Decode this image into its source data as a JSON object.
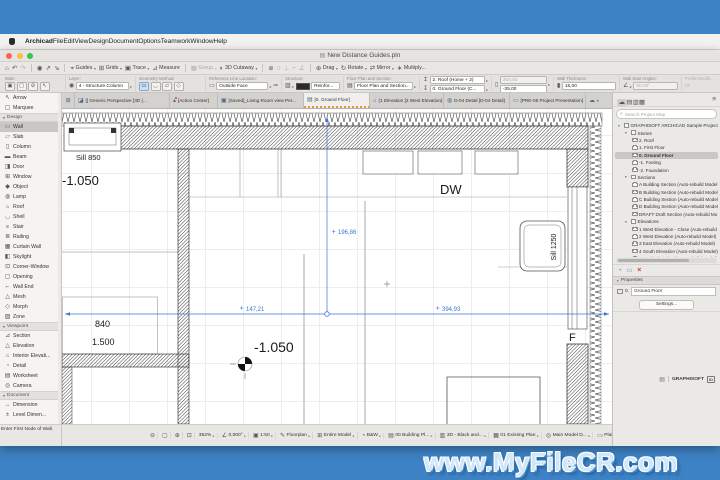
{
  "desktop": {
    "watermark": "www.MyFileCR.com"
  },
  "menu_bar": {
    "items": [
      {
        "label": "Archicad",
        "cls": "b",
        "name": "archicad"
      },
      {
        "label": "File",
        "name": "file"
      },
      {
        "label": "Edit",
        "name": "edit"
      },
      {
        "label": "View",
        "name": "view"
      },
      {
        "label": "Design",
        "name": "design"
      },
      {
        "label": "Document",
        "name": "document"
      },
      {
        "label": "Options",
        "name": "options"
      },
      {
        "label": "Teamwork",
        "name": "teamwork"
      },
      {
        "label": "Window",
        "name": "window"
      },
      {
        "label": "Help",
        "name": "help"
      }
    ]
  },
  "window": {
    "title": "New Distance Guides.pln"
  },
  "toolbar": {
    "items": [
      {
        "icon": "⌂",
        "name": "home"
      },
      {
        "icon": "↶",
        "name": "undo"
      },
      {
        "icon": "↷",
        "cls": "dis",
        "name": "redo"
      },
      {
        "cls": "sep",
        "name": "separator"
      },
      {
        "icon": "◉",
        "name": "favorites"
      },
      {
        "icon": "⇗",
        "name": "pick-up-parameters"
      },
      {
        "icon": "⇘",
        "name": "inject-parameters"
      },
      {
        "cls": "sep",
        "name": "separator"
      },
      {
        "icon": "⌖",
        "label": "Guides",
        "chev": "▾",
        "name": "guides"
      },
      {
        "icon": "⊞",
        "label": "Grids",
        "chev": "▾",
        "name": "grids"
      },
      {
        "icon": "▣",
        "label": "Trace",
        "chev": "▾",
        "name": "trace"
      },
      {
        "icon": "⊿",
        "label": "Measure",
        "name": "measure"
      },
      {
        "cls": "sep",
        "name": "separator"
      },
      {
        "icon": "▦",
        "label": "Group",
        "chev": "▾",
        "cls": "dis",
        "name": "group"
      },
      {
        "icon": "◐",
        "label": "3D Cutaway",
        "chev": "▾",
        "name": "3d-cutaway"
      },
      {
        "cls": "sep",
        "name": "separator"
      },
      {
        "icon": "⊚",
        "name": "link"
      },
      {
        "icon": "◌",
        "name": "find-select"
      },
      {
        "icon": "⊥",
        "cls": "dis",
        "name": "guide-segment"
      },
      {
        "icon": "⌐",
        "cls": "dis",
        "name": "guide-corner"
      },
      {
        "icon": "∠",
        "cls": "dis",
        "name": "guide-angle"
      },
      {
        "cls": "sep",
        "name": "separator"
      },
      {
        "icon": "⊕",
        "label": "Drag",
        "chev": "▾",
        "name": "drag"
      },
      {
        "icon": "↻",
        "label": "Rotate",
        "chev": "▾",
        "name": "rotate"
      },
      {
        "icon": "⇄",
        "label": "Mirror",
        "chev": "▾",
        "name": "mirror"
      },
      {
        "icon": "∗",
        "label": "Multiply...",
        "name": "multiply"
      }
    ]
  },
  "infobox": {
    "main_label": "Main:",
    "main_icons": [
      {
        "icon": "▣",
        "chev": "▸",
        "name": "wall-default-settings"
      },
      {
        "icon": "▢",
        "chev": "▸",
        "name": "favorites"
      },
      {
        "icon": "⊘",
        "name": "suspend-groups"
      },
      {
        "icon": "↖",
        "name": "arrow-tool"
      }
    ],
    "layer_label": "Layer:",
    "layer_eye": "◉",
    "layer_value": "4 - Structure.Column",
    "layer_chev": "▸",
    "geometry_label": "Geometry Method:",
    "geometry_icons": [
      {
        "icon": "▭",
        "cls": "act",
        "name": "straight"
      },
      {
        "icon": "◡",
        "name": "curved"
      },
      {
        "icon": "▱",
        "name": "trapezoid"
      },
      {
        "icon": "◇",
        "name": "polygonal"
      }
    ],
    "refline_label": "Reference Line Location:",
    "refline_icon": "▭",
    "refline_value": "Outside Face",
    "refline_chev": "▸",
    "refline_flip": "⇒",
    "structure_label": "Structure:",
    "structure_icon": "▥",
    "structure_chev": "▸",
    "structure_value": "Reinfor...",
    "fps_label": "Floor Plan and Section:",
    "fps_icon": "▤",
    "fps_value": "Floor Plan and Section...",
    "fps_chev": "▸",
    "linked_label": "Linked Stories:",
    "linked_top_icon": "↥",
    "linked_top": "2. Roof (Home + 2)",
    "linked_bottom_icon": "↧",
    "linked_bottom": "0. Ground Floor (C...",
    "linked_chev": "▸",
    "bt_label": "Bottom and Top:",
    "bt_icon": "▯",
    "bt_top": "303,00",
    "bt_bottom": "-35,00",
    "bt_chev": "▸",
    "thick_label": "Wall Thickness:",
    "thick_icon": "▮",
    "thick_value": "15,00",
    "angle_label": "Wall Start Angles:",
    "angle_icon": "∠",
    "angle_value": "90,00°",
    "angle_chev": "▸",
    "profile_label": "Profile Modifi...",
    "profile_icon": "▱"
  },
  "tab_bar": {
    "items": [
      {
        "icon": "⊞",
        "cls": "tovw",
        "name": "tab-overview"
      },
      {
        "icon": "◪",
        "label": "[] Generic Perspective [3D (...",
        "cls": "t1",
        "name": "tab-generic-perspective"
      },
      {
        "icon": "▴",
        "label": "[Action Center]",
        "cls": "t2",
        "name": "tab-action-center"
      },
      {
        "icon": "▣",
        "label": "[Saved]_Living Room view Per...",
        "cls": "t3",
        "name": "tab-living-room-view"
      },
      {
        "icon": "▤",
        "label": "[0. Ground Floor]",
        "cls": "t4 active",
        "name": "tab-ground-floor"
      },
      {
        "icon": "⌂",
        "label": "(1 Elevation [2 West Elevation]",
        "cls": "t5",
        "name": "tab-west-elevation"
      },
      {
        "icon": "◍",
        "label": "D-04 Detail [D-04 Detail]",
        "cls": "t6",
        "name": "tab-d04-detail"
      },
      {
        "icon": "▭",
        "label": "[PRE-05 Project Presentation]",
        "cls": "t7",
        "name": "tab-pre05-presentation"
      },
      {
        "icon": "☁",
        "chev": "▾",
        "cls": "tdrop",
        "name": "tab-list-dropdown"
      }
    ]
  },
  "toolbox": {
    "items": [
      {
        "icon": "↖",
        "label": "Arrow",
        "name": "arrow"
      },
      {
        "icon": "▢",
        "label": "Marquee",
        "name": "marquee"
      },
      {
        "label": "Design",
        "cls": "hdr",
        "caret": "▾",
        "name": "design-section"
      },
      {
        "icon": "▭",
        "label": "Wall",
        "cls": "sel",
        "name": "wall"
      },
      {
        "icon": "▱",
        "label": "Slab",
        "name": "slab"
      },
      {
        "icon": "▯",
        "label": "Column",
        "name": "column"
      },
      {
        "icon": "▬",
        "label": "Beam",
        "name": "beam"
      },
      {
        "icon": "◨",
        "label": "Door",
        "name": "door"
      },
      {
        "icon": "⊞",
        "label": "Window",
        "name": "window"
      },
      {
        "icon": "◆",
        "label": "Object",
        "name": "object"
      },
      {
        "icon": "◍",
        "label": "Lamp",
        "name": "lamp"
      },
      {
        "icon": "⌂",
        "label": "Roof",
        "name": "roof"
      },
      {
        "icon": "◡",
        "label": "Shell",
        "name": "shell"
      },
      {
        "icon": "≡",
        "label": "Stair",
        "name": "stair"
      },
      {
        "icon": "≣",
        "label": "Railing",
        "name": "railing"
      },
      {
        "icon": "▦",
        "label": "Curtain Wall",
        "name": "curtain-wall"
      },
      {
        "icon": "◧",
        "label": "Skylight",
        "name": "skylight"
      },
      {
        "icon": "⊡",
        "label": "Corner-Window",
        "name": "corner-window"
      },
      {
        "icon": "▢",
        "label": "Opening",
        "name": "opening"
      },
      {
        "icon": "⌐",
        "label": "Wall End",
        "name": "wall-end"
      },
      {
        "icon": "△",
        "label": "Mesh",
        "name": "mesh"
      },
      {
        "icon": "◇",
        "label": "Morph",
        "name": "morph"
      },
      {
        "icon": "▧",
        "label": "Zone",
        "name": "zone"
      },
      {
        "label": "Viewpoint",
        "cls": "hdr",
        "caret": "▾",
        "name": "viewpoint-section"
      },
      {
        "icon": "⊿",
        "label": "Section",
        "name": "section"
      },
      {
        "icon": "△",
        "label": "Elevation",
        "name": "elevation"
      },
      {
        "icon": "⌂",
        "label": "Interior Elevati...",
        "name": "interior-elevation"
      },
      {
        "icon": "◔",
        "label": "Detail",
        "name": "detail"
      },
      {
        "icon": "▤",
        "label": "Worksheet",
        "name": "worksheet"
      },
      {
        "icon": "◎",
        "label": "Camera",
        "name": "camera"
      },
      {
        "label": "Document",
        "cls": "hdr",
        "caret": "▾",
        "name": "document-section"
      },
      {
        "icon": "↔",
        "label": "Dimension",
        "name": "dimension"
      },
      {
        "icon": "±",
        "label": "Level Dimen...",
        "name": "level-dimension"
      }
    ]
  },
  "canvas": {
    "sill_850": "Sill 850",
    "level_left": "-1.050",
    "dim_840": "840",
    "dim_1500": "1.500",
    "level_center": "-1.050",
    "dw_label": "DW",
    "sill_1250": "Sill 1250",
    "f_label": "F",
    "dim_vertical": "196,86",
    "dim_left": "147,21",
    "dim_right": "394,93"
  },
  "navigator": {
    "header_icons": [
      {
        "icon": "☁",
        "cls": "act",
        "name": "teamwork-palette"
      },
      {
        "icon": "▤",
        "name": "project-map"
      },
      {
        "icon": "▥",
        "name": "view-map"
      },
      {
        "icon": "▦",
        "name": "layout-book"
      }
    ],
    "menu_icon": "≡",
    "search_placeholder": "Search Project Map",
    "tree": {
      "items": [
        {
          "label": "GRAPHISOFT ARCHICAD Sample Project - H",
          "lvl": 0,
          "caret": "▾",
          "name": "project-root"
        },
        {
          "label": "Stories",
          "lvl": 1,
          "caret": "▾",
          "name": "stories"
        },
        {
          "label": "2. Roof",
          "lvl": 2,
          "name": "story-roof"
        },
        {
          "label": "1. First Floor",
          "lvl": 2,
          "name": "story-first-floor"
        },
        {
          "label": "0. Ground Floor",
          "lvl": 2,
          "cls": "sel",
          "name": "story-ground-floor"
        },
        {
          "label": "-1. Footing",
          "lvl": 2,
          "name": "story-footing"
        },
        {
          "label": "-2. Foundation",
          "lvl": 2,
          "name": "story-foundation"
        },
        {
          "label": "Sections",
          "lvl": 1,
          "caret": "▾",
          "name": "sections"
        },
        {
          "label": "A Building Section (Auto-rebuild Model",
          "lvl": 2,
          "name": "section-a"
        },
        {
          "label": "B Building Section (Auto-rebuild Model",
          "lvl": 2,
          "name": "section-b"
        },
        {
          "label": "C Building Section (Auto-rebuild Model",
          "lvl": 2,
          "name": "section-c"
        },
        {
          "label": "D Building Section (Auto-rebuild Model",
          "lvl": 2,
          "name": "section-d"
        },
        {
          "label": "DRAFT Draft Section (Auto-rebuild Mo",
          "lvl": 2,
          "name": "section-draft"
        },
        {
          "label": "Elevations",
          "lvl": 1,
          "caret": "▾",
          "name": "elevations"
        },
        {
          "label": "1 West Elevation - Close (Auto-rebuild I",
          "lvl": 2,
          "name": "elev-west-close"
        },
        {
          "label": "2 West Elevation (Auto-rebuild Model)",
          "lvl": 2,
          "name": "elev-west"
        },
        {
          "label": "3 East Elevation (Auto-rebuild Model)",
          "lvl": 2,
          "name": "elev-east"
        },
        {
          "label": "4 South Elevation (Auto-rebuild Model)",
          "lvl": 2,
          "name": "elev-south"
        },
        {
          "label": "5 North Elevation (Auto-rebuild Model)",
          "lvl": 2,
          "name": "elev-north"
        },
        {
          "label": "Interior Elevations",
          "lvl": 1,
          "name": "interior-elevations"
        },
        {
          "label": "Worksheets",
          "lvl": 1,
          "caret": "▾",
          "name": "worksheets"
        },
        {
          "label": "0 Welcome (Independent)",
          "lvl": 2,
          "name": "ws-welcome"
        },
        {
          "label": "001 Site - Existing (Independent)",
          "lvl": 2,
          "name": "ws-site-existing"
        },
        {
          "label": "999 Twinmotion Renders (Independent",
          "lvl": 2,
          "name": "ws-twinmotion"
        },
        {
          "label": "Details",
          "lvl": 1,
          "caret": "▾",
          "name": "details"
        },
        {
          "label": "D-01 Detail (Drawing)",
          "lvl": 2,
          "name": "detail-d01"
        },
        {
          "label": "D-02 Detail (Drawing)",
          "lvl": 2,
          "name": "detail-d02"
        },
        {
          "label": "D-03 Detail (Drawing)",
          "lvl": 2,
          "name": "detail-d03"
        },
        {
          "label": "D-04 Detail (Drawing)",
          "lvl": 2,
          "name": "detail-d04"
        },
        {
          "label": "D-05 Detail (Drawing)",
          "lvl": 2,
          "name": "detail-d05"
        }
      ]
    },
    "action_icons": [
      {
        "icon": "◔",
        "name": "viewpoint-settings"
      },
      {
        "icon": "▭",
        "name": "properties-panel"
      },
      {
        "icon": "×",
        "cls": "redx",
        "name": "delete"
      }
    ],
    "properties": {
      "caret": "▾",
      "header": "Properties",
      "story_number": "0.",
      "story_name": "Ground Floor",
      "settings": "Settings..."
    },
    "footer": {
      "icon": "▤",
      "brand": "GRAPHISOFT",
      "badge": "ID"
    }
  },
  "status_bar": {
    "hint": "Enter First Node of Wall.",
    "items": [
      {
        "icon": "⊖",
        "name": "zoom-out"
      },
      {
        "icon": "▢",
        "name": "zoom-window"
      },
      {
        "icon": "⊕",
        "name": "zoom-in"
      },
      {
        "icon": "⊡",
        "name": "fit-in-window"
      },
      {
        "label": "352%",
        "chev": "▸",
        "name": "zoom-level"
      },
      {
        "icon": "∠",
        "label": "0,000°",
        "chev": "▸",
        "name": "orientation"
      },
      {
        "icon": "▣",
        "label": "1:50",
        "chev": "▸",
        "name": "scale"
      },
      {
        "icon": "✎",
        "label": "Floorplan",
        "chev": "▸",
        "name": "floor-plan-cut-plane"
      },
      {
        "icon": "⊞",
        "label": "Entire Model",
        "chev": "▸",
        "name": "structure-display"
      },
      {
        "icon": "◔",
        "label": "B&W",
        "chev": "▸",
        "name": "renovation-filter"
      },
      {
        "icon": "▤",
        "label": "00 Building Pl...",
        "chev": "▸",
        "name": "layer-combination"
      },
      {
        "icon": "▥",
        "label": "3D - Black and...",
        "chev": "▸",
        "name": "pen-set"
      },
      {
        "icon": "▦",
        "label": "01 Existing Plan",
        "chev": "▸",
        "name": "model-view-options"
      },
      {
        "icon": "◎",
        "label": "Main Model D...",
        "chev": "▸",
        "name": "graphic-override"
      },
      {
        "icon": "▭",
        "label": "Plain Millimeter",
        "chev": "▸",
        "name": "dimension-style"
      }
    ]
  }
}
